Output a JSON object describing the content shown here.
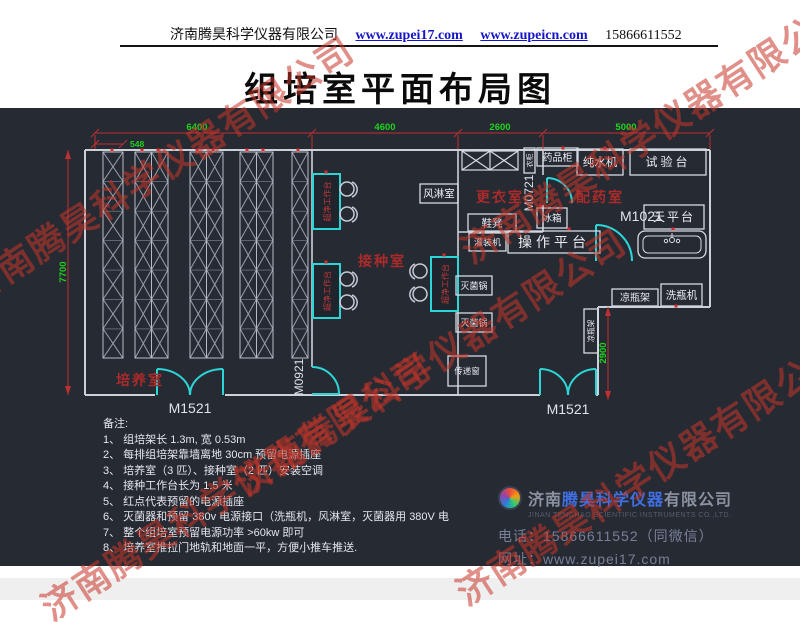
{
  "header": {
    "company": "济南腾昊科学仪器有限公司",
    "link1": "www.zupei17.com",
    "link2": "www.zupeicn.com",
    "phone": "15866611552"
  },
  "title": "组培室平面布局图",
  "watermark": {
    "text": "济南腾昊科学仪器有限公司"
  },
  "plan": {
    "dims": {
      "top_548": "548",
      "top_6400": "6400",
      "top_4600": "4600",
      "top_2600": "2600",
      "top_5000": "5000",
      "left_7700": "7700",
      "right_2900": "2900"
    },
    "rooms": {
      "culture": "培养室",
      "inoculation": "接种室",
      "changing": "更衣室",
      "dispensing": "配药室"
    },
    "doors": {
      "m1521": "M1521",
      "m0921": "M0921",
      "m0721": "M0721",
      "m1021": "M1021"
    },
    "equipment": {
      "air_shower": "风淋室",
      "wardrobe": "衣柜",
      "medicine_cabinet": "药品柜",
      "water_purifier": "纯水机",
      "test_bench": "试验台",
      "shoe_bench": "鞋凳",
      "fridge": "冰箱",
      "balance_table": "天平台",
      "filling_machine": "灌装机",
      "operation_platform": "操作平台",
      "sterilizer": "灭菌锅",
      "pass_window": "传递窗",
      "bottle_rack": "凉瓶架",
      "bottle_washer": "洗瓶机",
      "clean_bench": "超净工作台"
    }
  },
  "notes": {
    "title": "备注:",
    "items": [
      "1、 组培架长 1.3m, 宽 0.53m",
      "2、 每排组培架靠墙离地 30cm 预留电源插座",
      "3、 培养室（3 匹）、接种室（2 匹）安装空调",
      "4、 接种工作台长为 1.5 米",
      "5、 红点代表预留的电源插座",
      "6、 灭菌器和预留 380v 电源接口（洗瓶机，风淋室，灭菌器用 380V 电",
      "7、 整个组培室预留电源功率 >60kw 即可",
      "8、 培养室推拉门地轨和地面一平，方便小推车推送."
    ]
  },
  "footer": {
    "company_prefix": "济南",
    "company_brand": "腾昊科学仪器",
    "company_suffix": "有限公司",
    "company_en": "JINAN TENGHAO SCIENTIFIC INSTRUMENTS CO.,LTD.",
    "phone_label": "电话：",
    "phone": "15866611552（同微信）",
    "web_label": "网址：",
    "web": "www.zupei17.com"
  },
  "colors": {
    "panel_bg": "#262a33",
    "wall": "#ccd1d9",
    "rack": "#9aa1ad",
    "dimension_line": "#c03030",
    "dimension_text": "#1ed41e",
    "door": "#2cd6d6",
    "room_label": "#ab2a2a",
    "equipment_text": "#eceef2",
    "watermark_red": "#c63428",
    "link_blue": "#1414c8",
    "brand_blue": "#3f6fe0"
  }
}
